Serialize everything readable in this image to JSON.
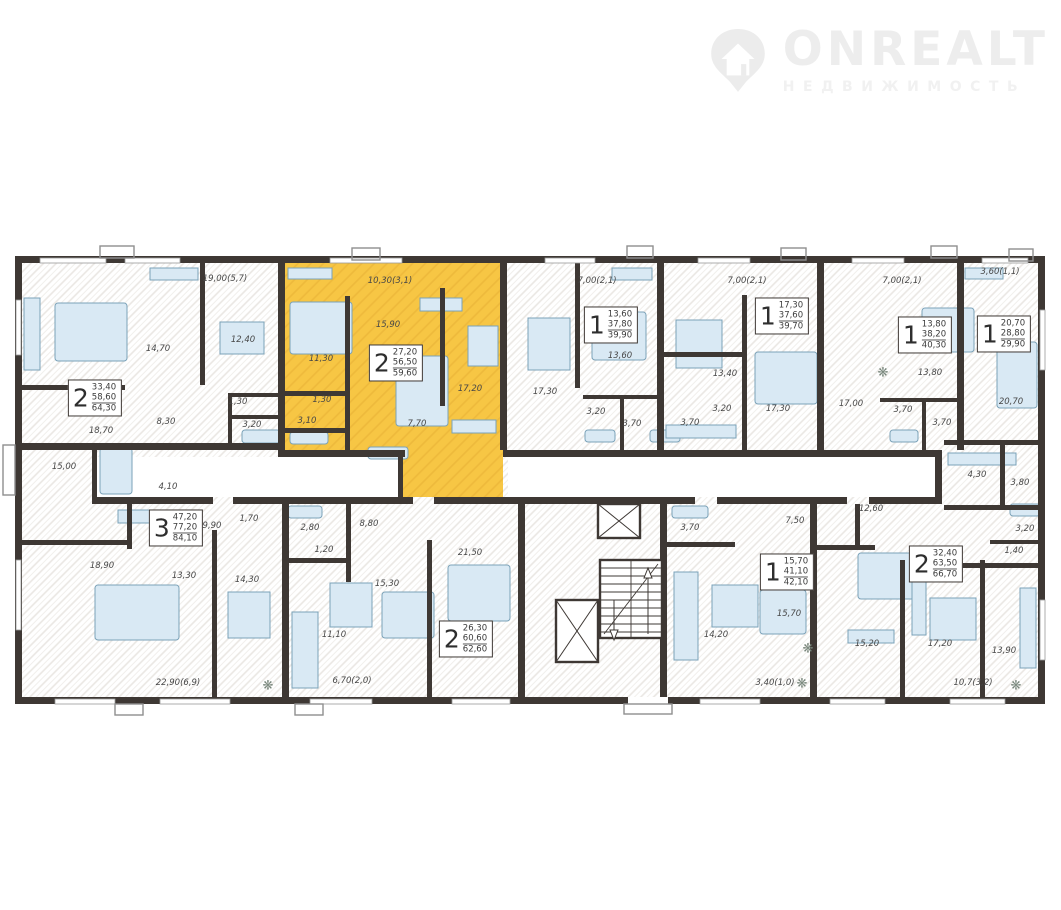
{
  "brand": {
    "name": "ONREALT",
    "subtitle": "НЕДВИЖИМОСТЬ"
  },
  "colors": {
    "highlight": "#f7c644",
    "wall": "#3e3834",
    "furniture": "#d9e9f4",
    "furniture-border": "#7ba2b8",
    "hatch": "#e9e6e2"
  },
  "plant_glyph": "❋",
  "highlighted_apartment": {
    "rooms": "2",
    "living_area": "27,20",
    "area": "56,50",
    "total_area": "59,60"
  },
  "dimension_labels": [
    {
      "t": "19,00(5,7)",
      "x": 225,
      "y": 279
    },
    {
      "t": "10,30(3,1)",
      "x": 390,
      "y": 281
    },
    {
      "t": "7,00(2,1)",
      "x": 597,
      "y": 281
    },
    {
      "t": "7,00(2,1)",
      "x": 747,
      "y": 281
    },
    {
      "t": "7,00(2,1)",
      "x": 902,
      "y": 281
    },
    {
      "t": "3,60(1,1)",
      "x": 1000,
      "y": 272
    },
    {
      "t": "22,90(6,9)",
      "x": 178,
      "y": 683
    },
    {
      "t": "6,70(2,0)",
      "x": 352,
      "y": 681
    },
    {
      "t": "3,40(1,0)",
      "x": 775,
      "y": 683
    },
    {
      "t": "10,7(3,2)",
      "x": 973,
      "y": 683
    }
  ],
  "apartment_boxes": [
    {
      "n": "2",
      "values": [
        "33,40",
        "58,60",
        "64,30"
      ],
      "x": 95,
      "y": 398,
      "highlighted": false
    },
    {
      "n": "2",
      "values": [
        "27,20",
        "56,50",
        "59,60"
      ],
      "x": 396,
      "y": 363,
      "highlighted": true
    },
    {
      "n": "1",
      "values": [
        "13,60",
        "37,80",
        "39,90"
      ],
      "x": 611,
      "y": 325,
      "highlighted": false
    },
    {
      "n": "1",
      "values": [
        "17,30",
        "37,60",
        "39,70"
      ],
      "x": 782,
      "y": 316,
      "highlighted": false
    },
    {
      "n": "1",
      "values": [
        "13,80",
        "38,20",
        "40,30"
      ],
      "x": 925,
      "y": 335,
      "highlighted": false
    },
    {
      "n": "1",
      "values": [
        "20,70",
        "28,80",
        "29,90"
      ],
      "x": 1004,
      "y": 334,
      "highlighted": false
    },
    {
      "n": "3",
      "values": [
        "47,20",
        "77,20",
        "84,10"
      ],
      "x": 176,
      "y": 528,
      "highlighted": false
    },
    {
      "n": "2",
      "values": [
        "26,30",
        "60,60",
        "62,60"
      ],
      "x": 466,
      "y": 639,
      "highlighted": false
    },
    {
      "n": "1",
      "values": [
        "15,70",
        "41,10",
        "42,10"
      ],
      "x": 787,
      "y": 572,
      "highlighted": false
    },
    {
      "n": "2",
      "values": [
        "32,40",
        "63,50",
        "66,70"
      ],
      "x": 936,
      "y": 564,
      "highlighted": false
    }
  ],
  "room_labels": [
    {
      "t": "14,70",
      "x": 158,
      "y": 349
    },
    {
      "t": "12,40",
      "x": 243,
      "y": 340
    },
    {
      "t": "8,30",
      "x": 166,
      "y": 422
    },
    {
      "t": "18,70",
      "x": 101,
      "y": 431
    },
    {
      "t": "1,30",
      "x": 238,
      "y": 402
    },
    {
      "t": "3,20",
      "x": 252,
      "y": 425
    },
    {
      "t": "15,90",
      "x": 388,
      "y": 325
    },
    {
      "t": "11,30",
      "x": 321,
      "y": 359
    },
    {
      "t": "1,30",
      "x": 322,
      "y": 400
    },
    {
      "t": "3,10",
      "x": 307,
      "y": 421
    },
    {
      "t": "17,20",
      "x": 470,
      "y": 389
    },
    {
      "t": "7,70",
      "x": 417,
      "y": 424
    },
    {
      "t": "13,60",
      "x": 620,
      "y": 356
    },
    {
      "t": "17,30",
      "x": 545,
      "y": 392
    },
    {
      "t": "3,20",
      "x": 596,
      "y": 412
    },
    {
      "t": "3,70",
      "x": 632,
      "y": 424
    },
    {
      "t": "3,70",
      "x": 690,
      "y": 423
    },
    {
      "t": "3,20",
      "x": 722,
      "y": 409
    },
    {
      "t": "13,40",
      "x": 725,
      "y": 374
    },
    {
      "t": "17,30",
      "x": 778,
      "y": 409
    },
    {
      "t": "17,00",
      "x": 851,
      "y": 404
    },
    {
      "t": "13,80",
      "x": 930,
      "y": 373
    },
    {
      "t": "3,70",
      "x": 903,
      "y": 410
    },
    {
      "t": "3,70",
      "x": 942,
      "y": 423
    },
    {
      "t": "20,70",
      "x": 1011,
      "y": 402
    },
    {
      "t": "4,30",
      "x": 977,
      "y": 475
    },
    {
      "t": "3,80",
      "x": 1020,
      "y": 483
    },
    {
      "t": "3,20",
      "x": 1025,
      "y": 529
    },
    {
      "t": "1,40",
      "x": 1014,
      "y": 551
    },
    {
      "t": "15,00",
      "x": 64,
      "y": 467
    },
    {
      "t": "4,10",
      "x": 168,
      "y": 487
    },
    {
      "t": "9,90",
      "x": 212,
      "y": 526
    },
    {
      "t": "1,70",
      "x": 249,
      "y": 519
    },
    {
      "t": "18,90",
      "x": 102,
      "y": 566
    },
    {
      "t": "13,30",
      "x": 184,
      "y": 576
    },
    {
      "t": "14,30",
      "x": 247,
      "y": 580
    },
    {
      "t": "2,80",
      "x": 310,
      "y": 528
    },
    {
      "t": "1,20",
      "x": 324,
      "y": 550
    },
    {
      "t": "8,80",
      "x": 369,
      "y": 524
    },
    {
      "t": "11,10",
      "x": 334,
      "y": 635
    },
    {
      "t": "15,30",
      "x": 387,
      "y": 584
    },
    {
      "t": "21,50",
      "x": 470,
      "y": 553
    },
    {
      "t": "3,70",
      "x": 690,
      "y": 528
    },
    {
      "t": "7,50",
      "x": 795,
      "y": 521
    },
    {
      "t": "14,20",
      "x": 716,
      "y": 635
    },
    {
      "t": "15,70",
      "x": 789,
      "y": 614
    },
    {
      "t": "12,60",
      "x": 871,
      "y": 509
    },
    {
      "t": "15,20",
      "x": 867,
      "y": 644
    },
    {
      "t": "17,20",
      "x": 940,
      "y": 644
    },
    {
      "t": "13,90",
      "x": 1004,
      "y": 651
    }
  ],
  "decorations": [
    {
      "x": 268,
      "y": 686
    },
    {
      "x": 802,
      "y": 684
    },
    {
      "x": 1016,
      "y": 686
    },
    {
      "x": 808,
      "y": 649
    },
    {
      "x": 883,
      "y": 373
    }
  ]
}
